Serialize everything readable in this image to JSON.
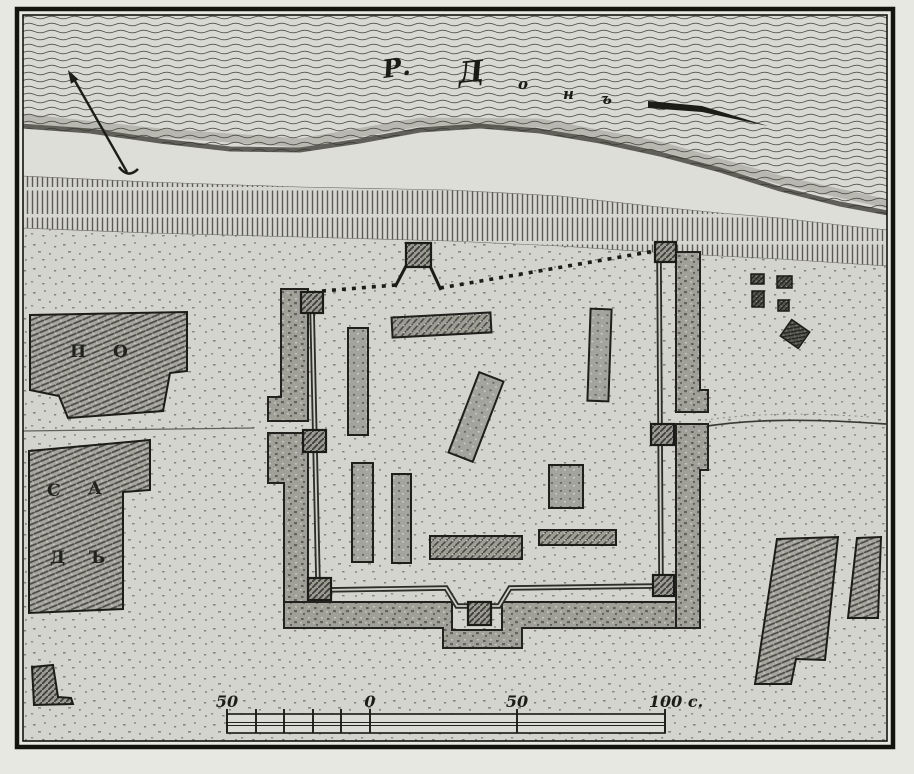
{
  "map": {
    "river": {
      "name_parts": [
        "Р.",
        "Д",
        "о",
        "н",
        "ъ"
      ]
    },
    "posad": {
      "letters": [
        "П",
        "О",
        "С",
        "А",
        "Д",
        "Ъ"
      ]
    },
    "scale_bar": {
      "labels": [
        "50",
        "0",
        "50",
        "100 с."
      ]
    },
    "icons": {
      "north_arrow": "north-arrow-icon",
      "flow_arrow": "flow-direction-arrow-icon"
    },
    "colors": {
      "paper_margin": "#e8e8e3",
      "land": "#d4d4ce",
      "beach": "#dedeD8",
      "ink": "#1d1d18",
      "water_line": "#50504a",
      "rampart_fill": "#a3a39d"
    }
  }
}
